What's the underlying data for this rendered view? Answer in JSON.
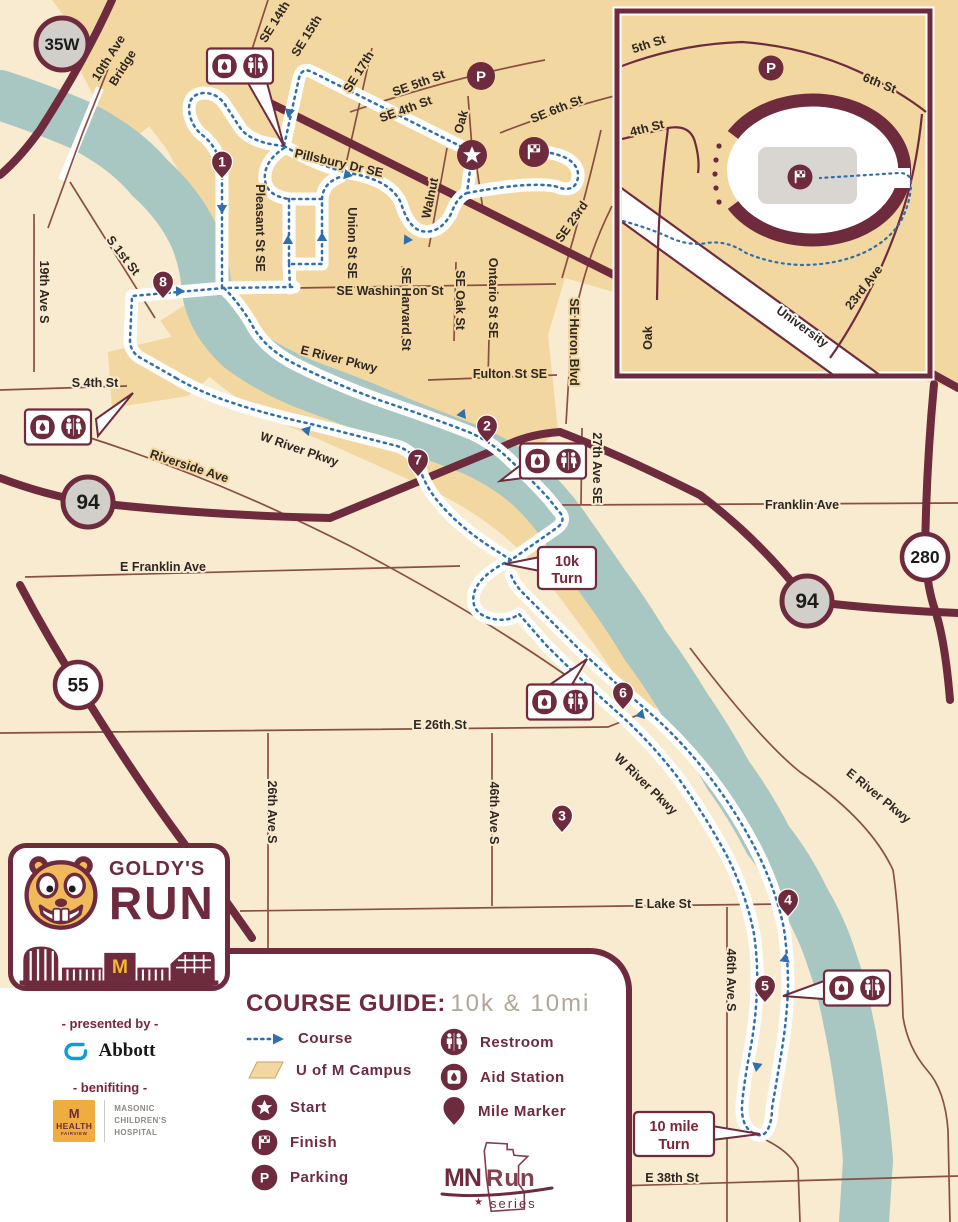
{
  "colors": {
    "cream": "#f8ebcf",
    "campus_tan": "#f3d7a1",
    "river": "#a9c7c2",
    "maroon": "#6e2b3e",
    "thin_road": "#8a4f44",
    "course_blue": "#2e6fad",
    "shield_gray": "#d2cfca",
    "field_gray": "#d9d6d2",
    "subtitle_tan": "#b3a696",
    "abbott_blue": "#0b9ed9",
    "mhealth_gold": "#eead3e"
  },
  "icons": {
    "star": "★"
  },
  "map": {
    "p_letter": "P",
    "mile_markers": [
      "1",
      "2",
      "3",
      "4",
      "5",
      "6",
      "7",
      "8"
    ],
    "shields": {
      "s35": "35W",
      "s94": "94",
      "s280": "280",
      "s55": "55"
    },
    "callouts": {
      "tenk1": "10k",
      "tenk2": "Turn",
      "tenmile1": "10 mile",
      "tenmile2": "Turn"
    },
    "labels": {
      "tenth1": "10th Ave",
      "tenth2": "Bridge",
      "se14": "SE 14th",
      "se15": "SE 15th",
      "se17": "SE 17th",
      "se5": "SE 5th St",
      "se4": "SE 4th St",
      "se6": "SE 6th St",
      "oak_u": "Oak",
      "pillsbury": "Pillsbury Dr SE",
      "walnut": "Walnut",
      "se23": "SE 23rd",
      "union": "Union St SE",
      "pleasant": "Pleasant St SE",
      "washington": "SE Washington St",
      "harvard": "SE Harvard St",
      "oakst": "SE Oak St",
      "ontario": "Ontario St SE",
      "huron": "SE Huron Blvd",
      "fulton": "Fulton St SE",
      "ave27": "27th Ave SE",
      "ave19": "19th Ave S",
      "s1st": "S 1st St",
      "s4th": "S 4th St",
      "eriver1": "E River Pkwy",
      "wriver1": "W River Pkwy",
      "riverside": "Riverside Ave",
      "franklin": "Franklin Ave",
      "efranklin": "E Franklin Ave",
      "e26": "E 26th St",
      "ave26": "26th Ave S",
      "ave46a": "46th Ave S",
      "ave46b": "46th Ave S",
      "wriver2": "W River Pkwy",
      "eriver2": "E River Pkwy",
      "elake": "E Lake St",
      "e38": "E 38th St"
    },
    "inset": {
      "i5": "5th St",
      "i6": "6th St",
      "i4": "4th St",
      "ioak": "Oak",
      "i23": "23rd Ave",
      "iuni": "University"
    }
  },
  "logo": {
    "goldys": "GOLDY'S",
    "run": "RUN",
    "m_letter": "M"
  },
  "panel": {
    "title": "COURSE GUIDE:",
    "subtitle": "10k & 10mi",
    "legend_col1": [
      "Course",
      "U of M Campus",
      "Start",
      "Finish",
      "Parking"
    ],
    "legend_col2": [
      "Restroom",
      "Aid Station",
      "Mile Marker"
    ]
  },
  "mnrun": {
    "mn": "MN",
    "run": "Run",
    "series": "series"
  },
  "sponsors": {
    "presented": "- presented by -",
    "abbott": "Abbott",
    "benefiting": "- benifiting -",
    "health_m": "M",
    "health_1": "HEALTH",
    "health_2": "FAIRVIEW",
    "masonic": [
      "MASONIC",
      "CHILDREN'S",
      "HOSPITAL"
    ]
  }
}
